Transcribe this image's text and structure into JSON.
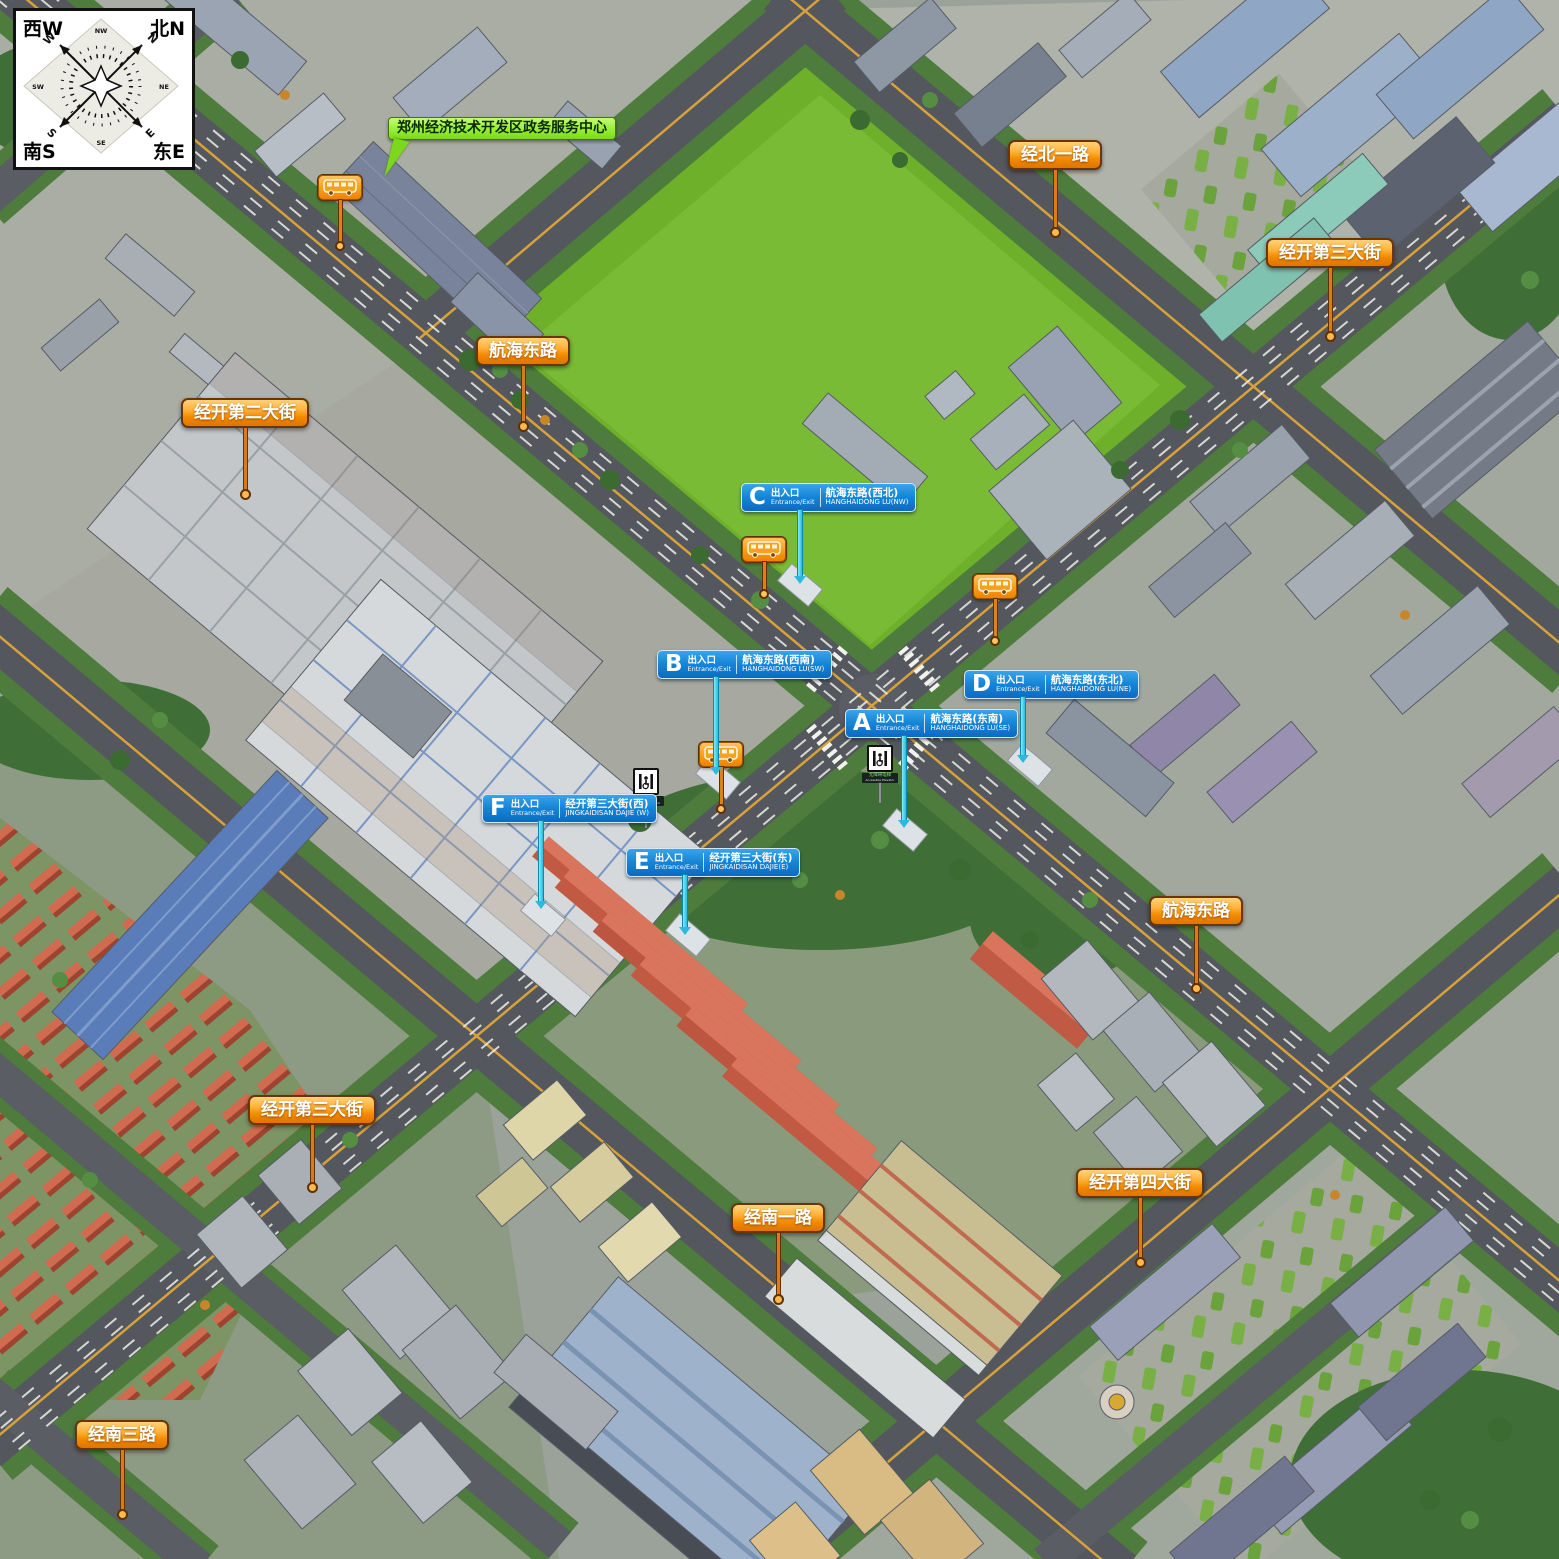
{
  "compass": {
    "corners": {
      "top_left": "西W",
      "top_right": "北N",
      "bottom_left": "南S",
      "bottom_right": "东E"
    },
    "rose": {
      "w": "W",
      "n": "N",
      "s": "S",
      "e": "E",
      "nw": "NW",
      "ne": "NE",
      "sw": "SW",
      "se": "SE"
    }
  },
  "poi_callout": {
    "text": "郑州经济技术开发区政务服务中心"
  },
  "road_labels": {
    "jingbei1": "经北一路",
    "jingkai3_n": "经开第三大街",
    "hanghai_w": "航海东路",
    "jingkai2": "经开第二大街",
    "hanghai_e": "航海东路",
    "jingkai3_s": "经开第三大街",
    "jingkai4": "经开第四大街",
    "jingnan1": "经南一路",
    "jingnan3": "经南三路"
  },
  "entrances": {
    "a": {
      "letter": "A",
      "type_cn": "出入口",
      "type_en": "Entrance/Exit",
      "road_cn": "航海东路(东南)",
      "road_en": "HANGHAIDONG LU(SE)"
    },
    "b": {
      "letter": "B",
      "type_cn": "出入口",
      "type_en": "Entrance/Exit",
      "road_cn": "航海东路(西南)",
      "road_en": "HANGHAIDONG LU(SW)"
    },
    "c": {
      "letter": "C",
      "type_cn": "出入口",
      "type_en": "Entrance/Exit",
      "road_cn": "航海东路(西北)",
      "road_en": "HANGHAIDONG LU(NW)"
    },
    "d": {
      "letter": "D",
      "type_cn": "出入口",
      "type_en": "Entrance/Exit",
      "road_cn": "航海东路(东北)",
      "road_en": "HANGHAIDONG LU(NE)"
    },
    "e": {
      "letter": "E",
      "type_cn": "出入口",
      "type_en": "Entrance/Exit",
      "road_cn": "经开第三大街(东)",
      "road_en": "JINGKAIDISAN DAJIE(E)"
    },
    "f": {
      "letter": "F",
      "type_cn": "出入口",
      "type_en": "Entrance/Exit",
      "road_cn": "经开第三大街(西)",
      "road_en": "JINGKAIDISAN DAJIE (W)"
    }
  },
  "accessibility": {
    "elevator_cn": "无障碍电梯",
    "elevator_en": "Accessible Elevator"
  },
  "colors": {
    "road_label_orange": "#f28a00",
    "entrance_blue": "#1787d8",
    "poi_green": "#95ef33",
    "field_green": "#6fb02b",
    "stick_cyan": "#2cb9dd",
    "bus_orange": "#f79d17"
  }
}
